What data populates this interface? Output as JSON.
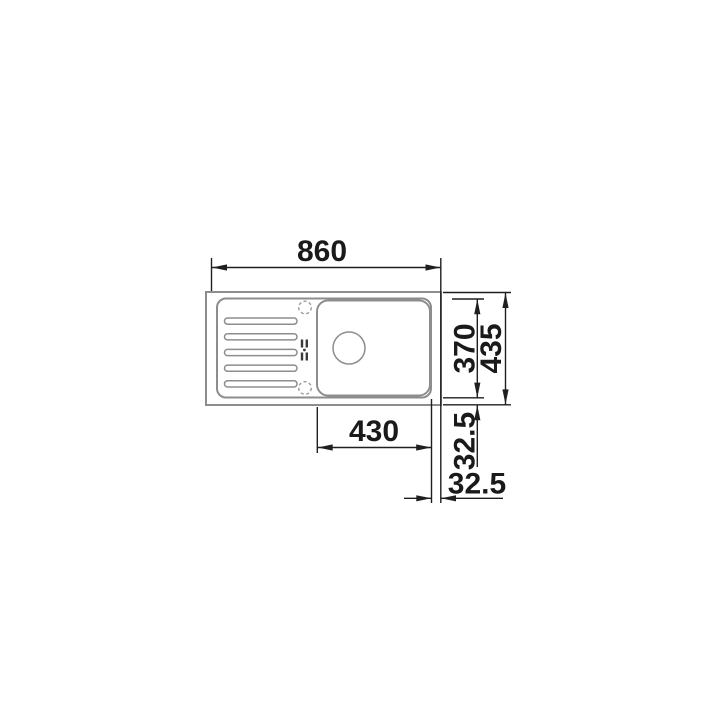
{
  "drawing": {
    "type": "sink-installation-dimension-diagram",
    "view": "top plan view of inset sink with drainboard and single bowl",
    "dimensions": {
      "overall_width": "860",
      "overall_depth": "435",
      "rim_depth": "370",
      "bowl_width": "430",
      "depth_offset": "32.5",
      "width_offset": "32.5"
    },
    "features": {
      "drainboard_groove_count": 5,
      "tap_hole_count": 2,
      "icons": [
        "tap-hole-icon",
        "drain-hole-icon",
        "mounting-clip-icon",
        "drainboard-groove"
      ]
    },
    "colors": {
      "background": "#ffffff",
      "sink_outline_gray": "#8d8d8d",
      "dimension_black": "#1f1f1f",
      "label_text": "#1a1a1a"
    }
  }
}
